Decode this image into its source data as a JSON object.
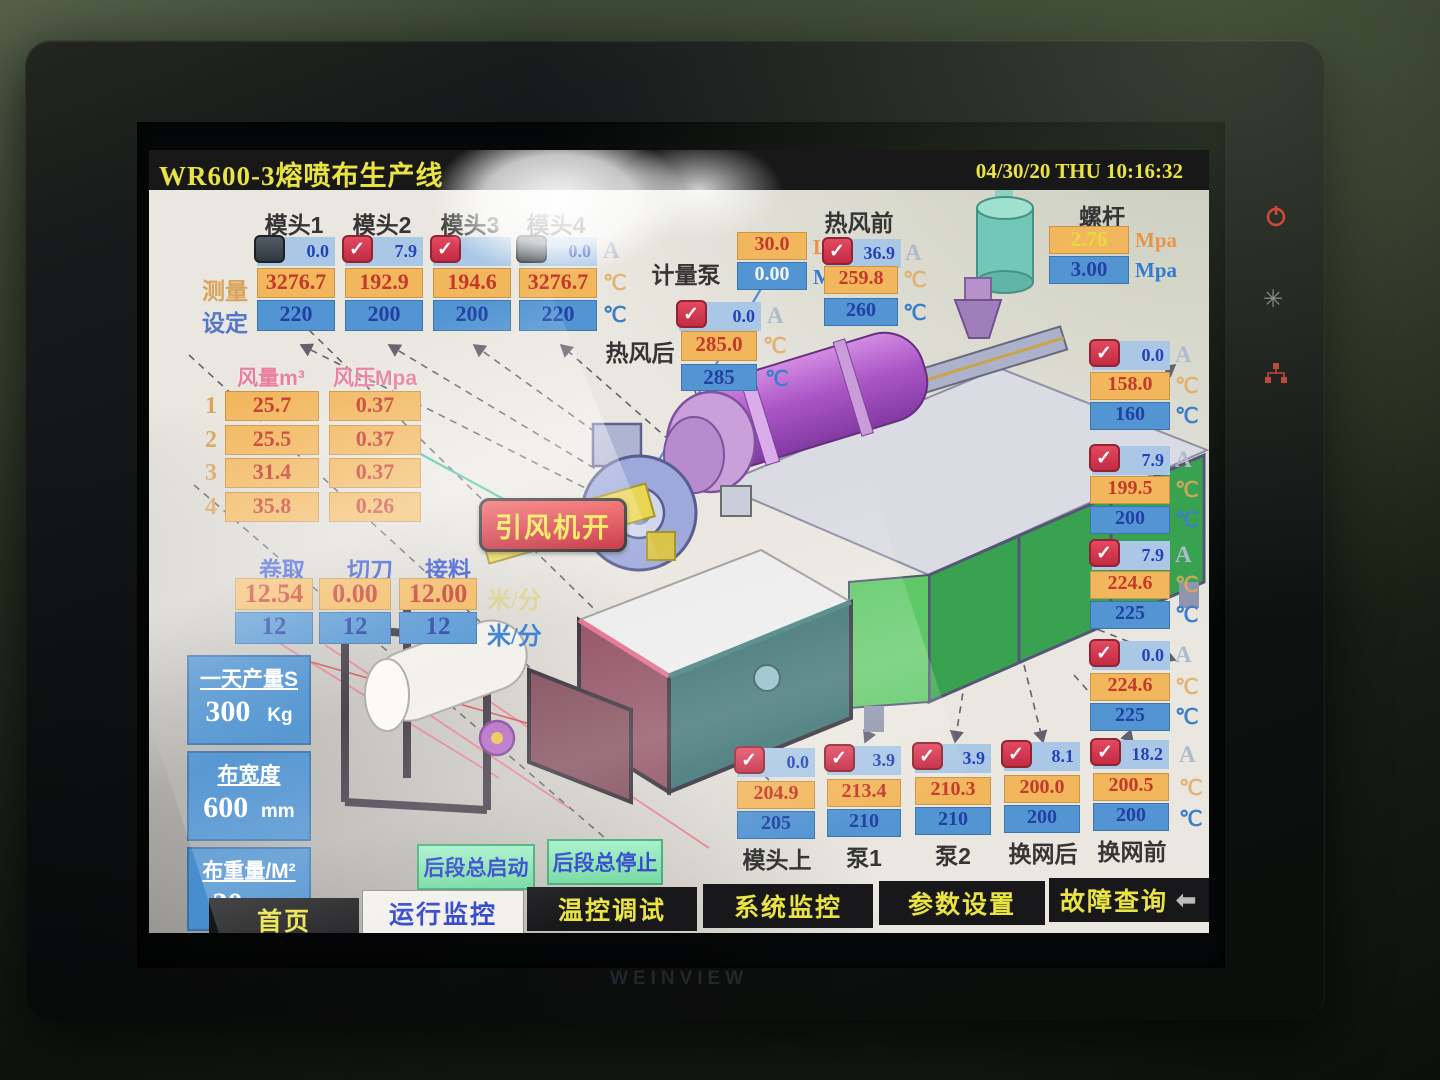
{
  "header": {
    "title": "WR600-3熔喷布生产线",
    "datetime": "04/30/20 THU 10:16:32"
  },
  "labels": {
    "measure": "测量",
    "set": "设定",
    "unit_a": "A",
    "unit_c": "℃",
    "unit_lmin": "L/min",
    "unit_mpa": "Mpa",
    "unit_mmin": "米/分"
  },
  "dieheads": {
    "items": [
      {
        "label": "模头1",
        "on": false,
        "amp": "0.0",
        "measured": "3276.7",
        "set": "220"
      },
      {
        "label": "模头2",
        "on": true,
        "amp": "7.9",
        "measured": "192.9",
        "set": "200"
      },
      {
        "label": "模头3",
        "on": true,
        "amp": "",
        "measured": "194.6",
        "set": "200"
      },
      {
        "label": "模头4",
        "on": false,
        "amp": "0.0",
        "measured": "3276.7",
        "set": "220"
      }
    ]
  },
  "metering_pump": {
    "label": "计量泵",
    "flow": "30.0",
    "pressure": "0.00"
  },
  "hot_air_rear": {
    "label": "热风后",
    "amp": "0.0",
    "measured": "285.0",
    "set": "285"
  },
  "hot_air_front": {
    "label": "热风前",
    "amp": "36.9",
    "measured": "259.8",
    "set": "260"
  },
  "screw": {
    "label": "螺杆",
    "measured": "2.76",
    "set": "3.00"
  },
  "fan_table": {
    "col_volume": "风量m³",
    "col_pressure": "风压Mpa",
    "rows": [
      {
        "no": "1",
        "volume": "25.7",
        "pressure": "0.37"
      },
      {
        "no": "2",
        "volume": "25.5",
        "pressure": "0.37"
      },
      {
        "no": "3",
        "volume": "31.4",
        "pressure": "0.37"
      },
      {
        "no": "4",
        "volume": "35.8",
        "pressure": "0.26"
      }
    ]
  },
  "fan_button": {
    "label": "引风机开"
  },
  "speeds": {
    "unit": "米/分",
    "items": [
      {
        "label": "卷取",
        "measured": "12.54",
        "set": "12"
      },
      {
        "label": "切刀",
        "measured": "0.00",
        "set": "12"
      },
      {
        "label": "接料",
        "measured": "12.00",
        "set": "12"
      }
    ]
  },
  "production": {
    "items": [
      {
        "title": "一天产量S",
        "value": "300",
        "unit": "Kg"
      },
      {
        "title": "布宽度",
        "value": "600",
        "unit": "mm"
      },
      {
        "title": "布重量/M²",
        "value": "30",
        "unit": "g"
      }
    ]
  },
  "right_column": {
    "items": [
      {
        "amp": "0.0",
        "measured": "158.0",
        "set": "160"
      },
      {
        "amp": "7.9",
        "measured": "199.5",
        "set": "200"
      },
      {
        "amp": "7.9",
        "measured": "224.6",
        "set": "225"
      },
      {
        "amp": "0.0",
        "measured": "224.6",
        "set": "225"
      }
    ]
  },
  "bottom_row": {
    "items": [
      {
        "label": "模头上",
        "amp": "0.0",
        "measured": "204.9",
        "set": "205"
      },
      {
        "label": "泵1",
        "amp": "3.9",
        "measured": "213.4",
        "set": "210"
      },
      {
        "label": "泵2",
        "amp": "3.9",
        "measured": "210.3",
        "set": "210"
      },
      {
        "label": "换网后",
        "amp": "8.1",
        "measured": "200.0",
        "set": "200"
      },
      {
        "label": "换网前",
        "amp": "18.2",
        "measured": "200.5",
        "set": "200"
      }
    ]
  },
  "rear_buttons": {
    "start": "后段总启动",
    "stop": "后段总停止"
  },
  "nav": {
    "items": [
      {
        "label": "首页"
      },
      {
        "label": "运行监控"
      },
      {
        "label": "温控调试"
      },
      {
        "label": "系统监控"
      },
      {
        "label": "参数设置"
      },
      {
        "label": "故障查询"
      }
    ]
  },
  "bezel": {
    "logo": "WEINVIEW"
  },
  "colors": {
    "accent_yellow": "#e8e23a",
    "measured_bg": "#f2b455",
    "measured_text": "#c22f20",
    "set_bg": "#4a90d0",
    "set_text": "#17379f",
    "checkbox_on": "#d8324a",
    "button_green": "#7ce8b0",
    "alarm_red": "#e03030"
  }
}
